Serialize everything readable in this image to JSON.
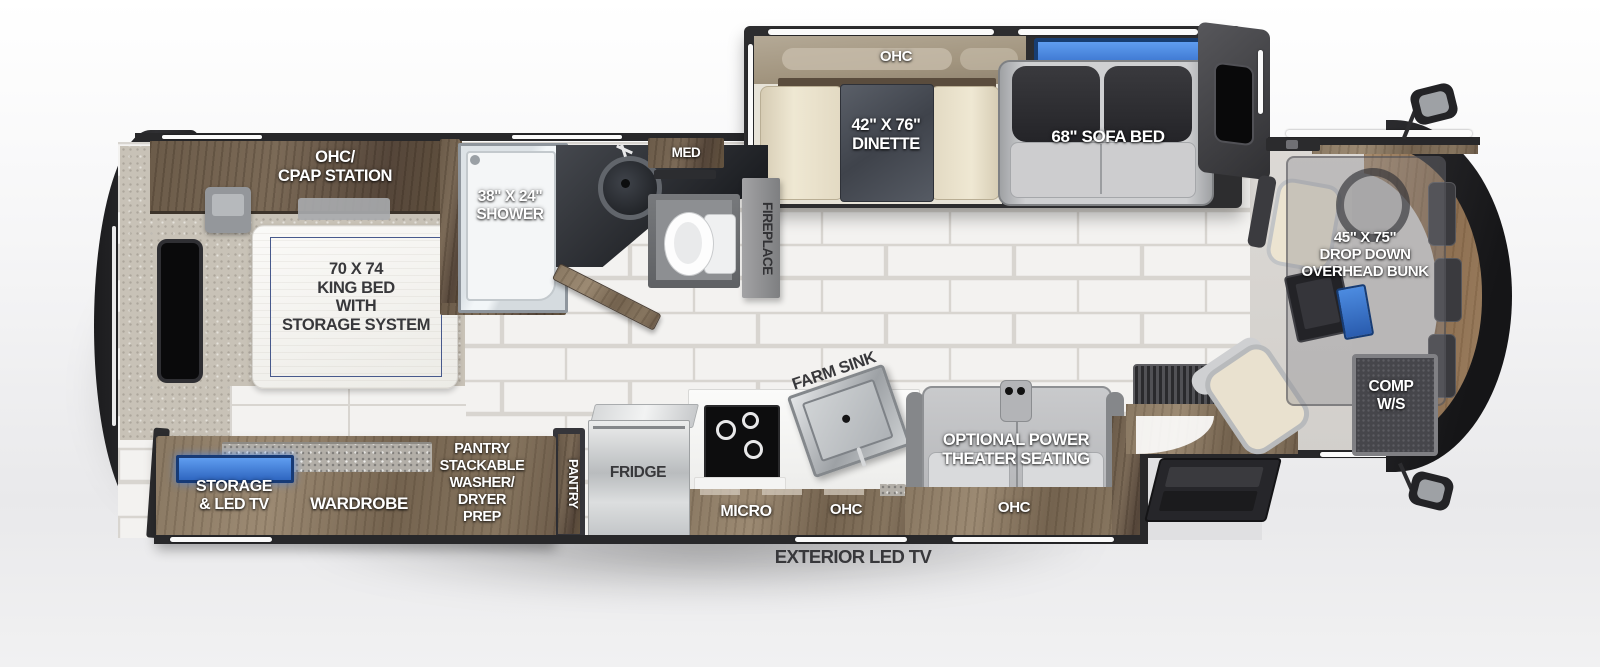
{
  "plan": {
    "slide_top": {
      "ohc": "OHC",
      "dinette": "42\" X 76\"\nDINETTE",
      "sofa_bed": "68\" SOFA BED"
    },
    "bedroom": {
      "ohc_cpap": "OHC/\nCPAP STATION",
      "king_bed": "70 X 74\nKING BED\nWITH\nSTORAGE SYSTEM"
    },
    "bathroom": {
      "shower": "38\" X 24\"\nSHOWER",
      "med": "MED"
    },
    "living": {
      "fireplace": "FIREPLACE",
      "theater": "OPTIONAL POWER\nTHEATER SEATING",
      "theater_ohc": "OHC"
    },
    "kitchen": {
      "farm_sink": "FARM SINK",
      "micro": "MICRO",
      "ohc": "OHC",
      "fridge": "FRIDGE",
      "pantry": "PANTRY",
      "pantry_stack": "PANTRY\nSTACKABLE\nWASHER/\nDRYER\nPREP"
    },
    "rear_slide": {
      "storage_tv": "STORAGE\n& LED TV",
      "wardrobe": "WARDROBE"
    },
    "cab": {
      "bunk": "45\" X 75\"\nDROP DOWN\nOVERHEAD BUNK",
      "comp": "COMP\nW/S",
      "ohc": "OHC"
    },
    "exterior": {
      "led_tv": "EXTERIOR LED TV"
    }
  },
  "colors": {
    "accent_blue": "#3a7fd5",
    "wood": "#7b6852",
    "body_outline": "#242427",
    "tile": "#f3f2f0",
    "label_dark": "#38383b"
  }
}
